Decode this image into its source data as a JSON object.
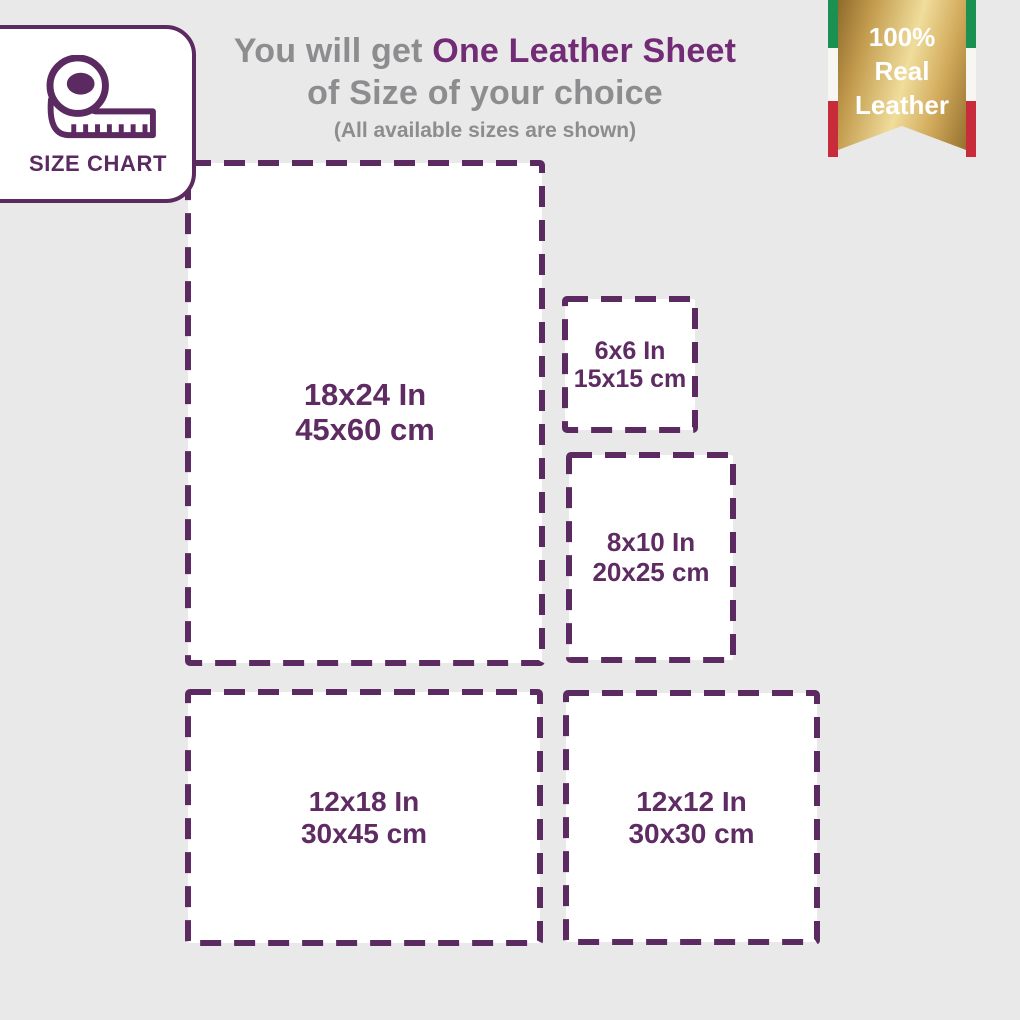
{
  "badge_card": {
    "label": "SIZE CHART",
    "icon": "measuring-tape-icon"
  },
  "title": {
    "prefix": "You will get ",
    "highlight": "One Leather Sheet",
    "line2": "of Size of your choice",
    "subtitle": "(All available sizes are shown)"
  },
  "ribbon": {
    "line1": "100%",
    "line2": "Real",
    "line3": "Leather",
    "flag_colors": {
      "green": "#1a9150",
      "white": "#f7f6f3",
      "red": "#c82b39"
    },
    "gold_light": "#f0dd9c",
    "gold_dark": "#8f6b2c"
  },
  "sizes": [
    {
      "id": "18x24",
      "inches": "18x24 In",
      "cm": "45x60 cm"
    },
    {
      "id": "6x6",
      "inches": "6x6 In",
      "cm": "15x15 cm"
    },
    {
      "id": "8x10",
      "inches": "8x10 In",
      "cm": "20x25 cm"
    },
    {
      "id": "12x18",
      "inches": "12x18 In",
      "cm": "30x45 cm"
    },
    {
      "id": "12x12",
      "inches": "12x12 In",
      "cm": "30x30 cm"
    }
  ],
  "colors": {
    "background": "#eae9e9",
    "box_fill": "#ffffff",
    "dash_purple": "#5b2a60",
    "label_purple": "#5e2b62",
    "title_purple": "#722c75",
    "title_gray": "#8d8c8e"
  }
}
